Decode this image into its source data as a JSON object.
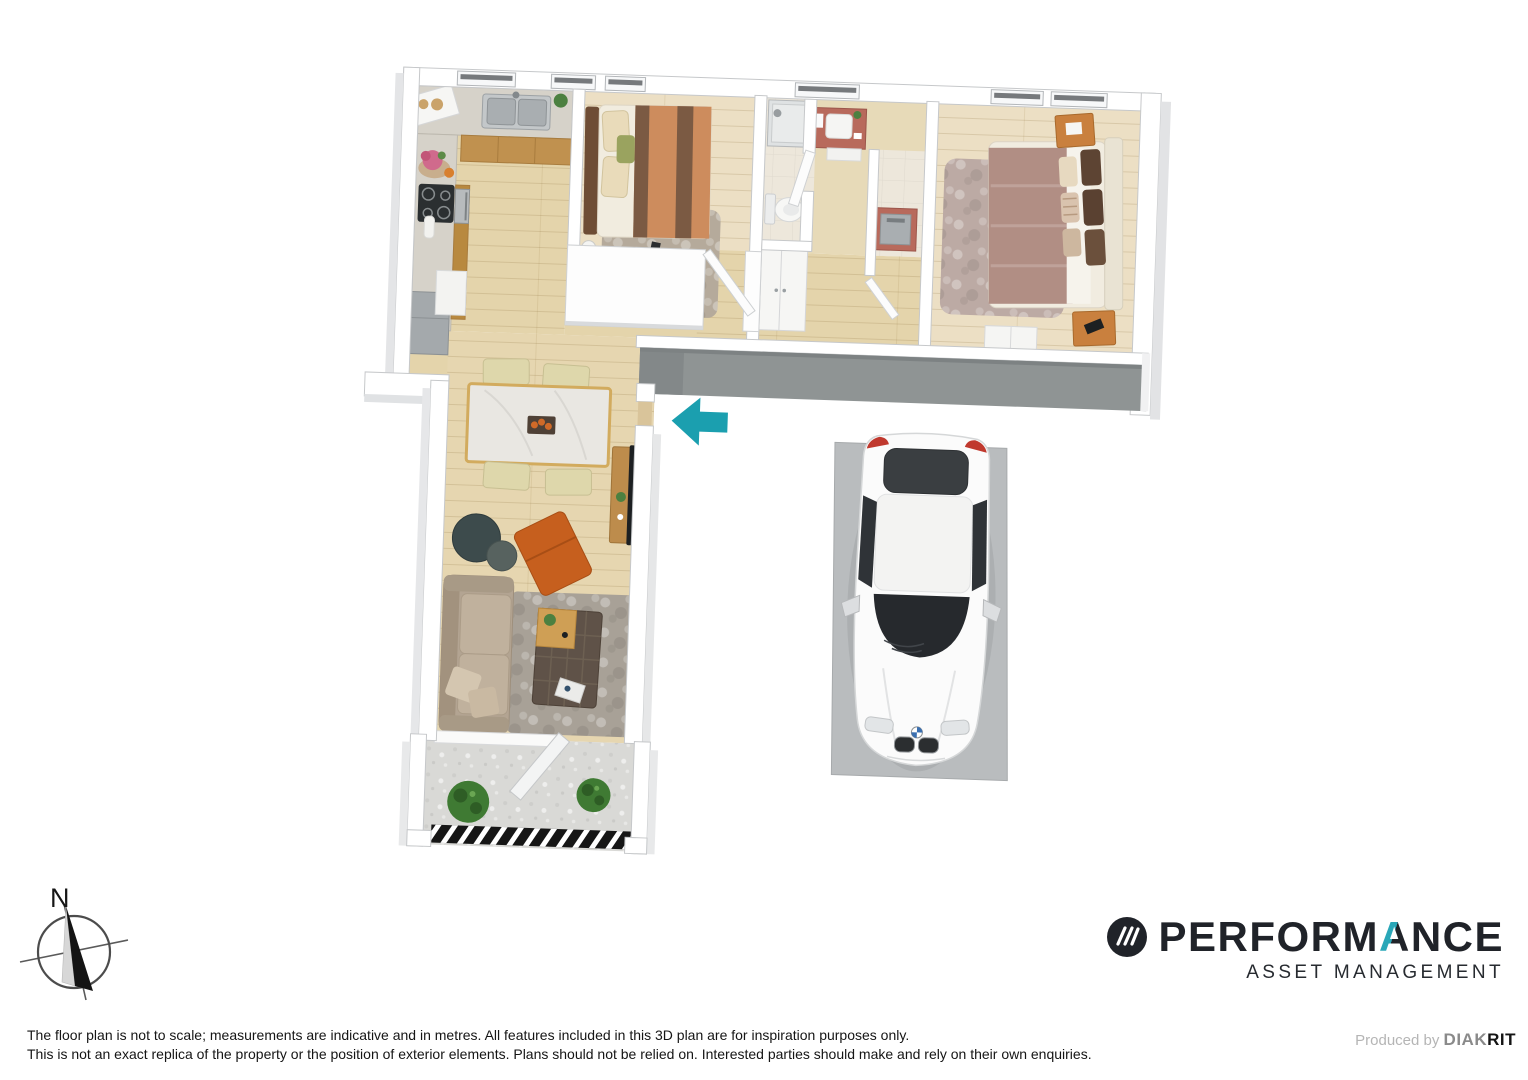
{
  "page": {
    "width": 1528,
    "height": 1080,
    "background": "#ffffff"
  },
  "plan": {
    "kind": "3D floor plan",
    "rooms_depicted": [
      "kitchen",
      "bedroom 1",
      "bathroom",
      "laundry",
      "bedroom 2",
      "living and dining",
      "balcony",
      "car space"
    ],
    "palette": {
      "wall": "#ffffff",
      "wall_outline": "#c6c8ca",
      "wall_side": "#e4e5e7",
      "wall_shadow_face": "#8f9494",
      "floor_wood": "#e4d4ab",
      "floor_wood_light": "#ecdfc4",
      "floor_tile": "#ede7db",
      "balcony_concrete": "#d9d9d6",
      "parking_pad": "#b9bcbe",
      "rug_gray": "#a8a197",
      "rug_taupe": "#b5aa9b",
      "rug_mauve": "#bcaaa4",
      "sofa": "#b3a492",
      "bed1_duvet": "#cd8c5d",
      "bed1_duvet_band": "#7b5a43",
      "bed2_duvet": "#b18e84",
      "accent_orange": "#c65f1e",
      "timber": "#c0914f",
      "car_body": "#fbfbfb",
      "glass": "#2f3337",
      "plant": "#3f7a33"
    }
  },
  "entry_arrow": {
    "meaning": "entrance",
    "direction": "left",
    "color": "#1b9faf"
  },
  "compass": {
    "label": "N"
  },
  "branding": {
    "logo": {
      "word_pre": "PERFORM",
      "accent_letter": "A",
      "word_post": "NCE",
      "subtitle": "ASSET MANAGEMENT",
      "text_color": "#202329",
      "accent_color": "#2aa7b8"
    },
    "produced_by": {
      "prefix": "Produced by ",
      "brand_left": "DIAK",
      "brand_right": "RIT"
    }
  },
  "footer": {
    "disclaimer_line1": "The floor plan is not to scale; measurements are indicative and in metres. All features included in this 3D plan are for inspiration purposes only.",
    "disclaimer_line2": "This is not an exact replica of the property or the position of exterior elements. Plans should not be relied on. Interested parties should make and rely on their own enquiries."
  }
}
